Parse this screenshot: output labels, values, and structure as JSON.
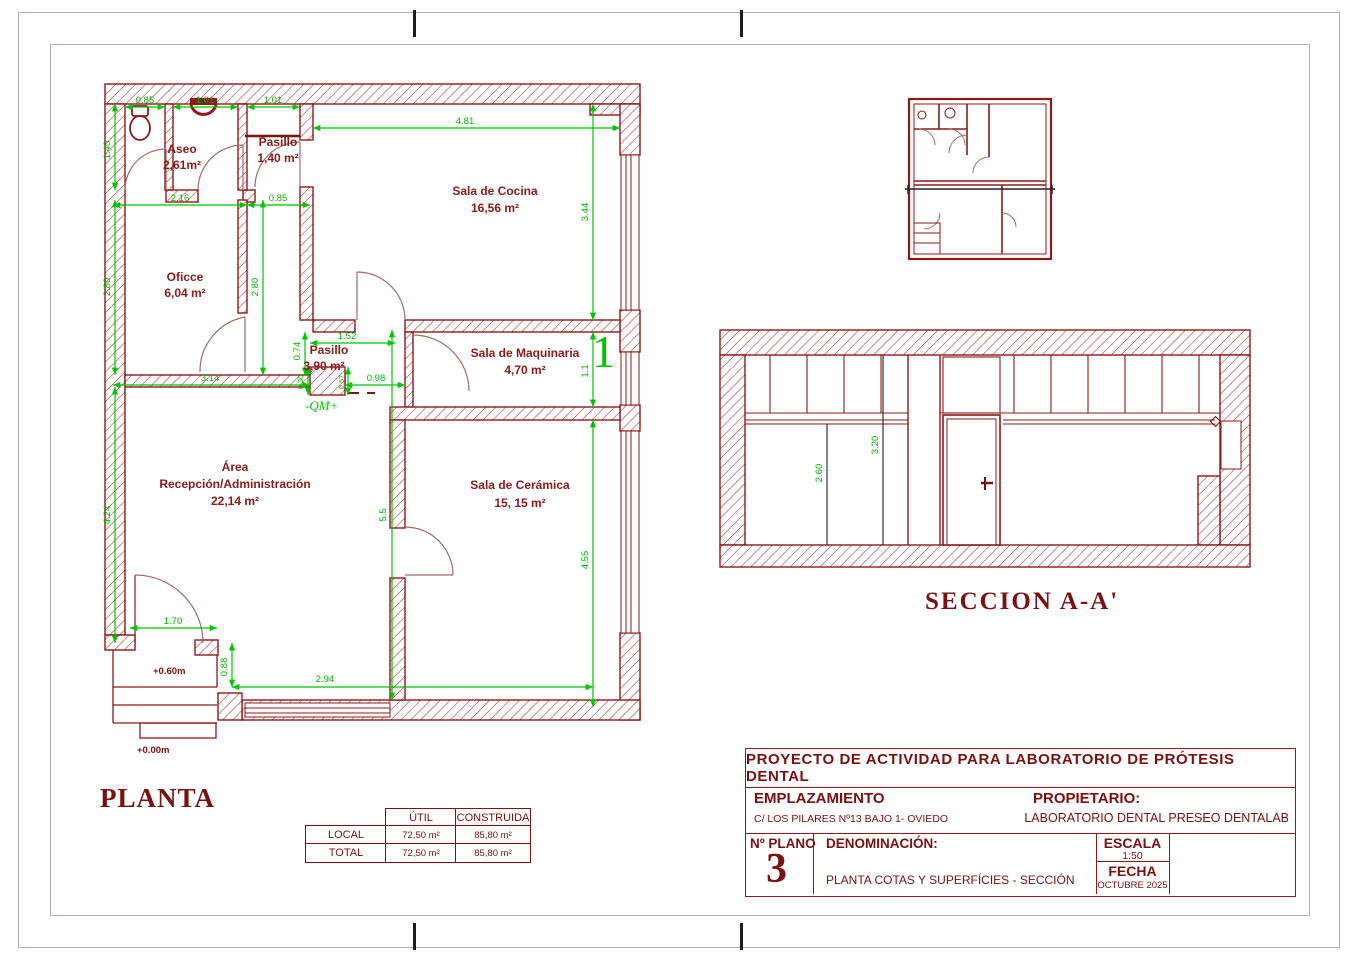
{
  "sheet": {
    "planta_label": "PLANTA",
    "seccion_label": "SECCION A-A'"
  },
  "plan": {
    "rooms": {
      "aseo": {
        "name": "Aseo",
        "area": "2,61m²"
      },
      "pasillo_top": {
        "name": "Pasillo",
        "area": "1,40 m²"
      },
      "oficce": {
        "name": "Oficce",
        "area": "6,04 m²"
      },
      "cocina": {
        "name": "Sala de Cocina",
        "area": "16,56 m²"
      },
      "pasillo_mid": {
        "name": "Pasillo",
        "area": "3,90 m²"
      },
      "maquinaria": {
        "name": "Sala de Maquinaria",
        "area": "4,70 m²"
      },
      "recepcion": {
        "line1": "Área",
        "line2": "Recepción/Administración",
        "area": "22,14 m²"
      },
      "ceramica": {
        "name": "Sala de Cerámica",
        "area": "15, 15 m²"
      }
    },
    "dims": {
      "aseo_w": "0.85",
      "sink_w": "1.01",
      "pasillo_w": "1.01",
      "cocina_w": "4.81",
      "aseo_total_w": "2.16",
      "pasillo_mid_w": "0.85",
      "aseo_h": "1.40",
      "oficce_h": "2.80",
      "oficce_h_inner": "2.80",
      "recepcion_h": "4.24",
      "cocina_h": "3.44",
      "maquinaria_h": "1.1",
      "ceramica_h": "4.55",
      "recepcion_inner_h": "5.5",
      "pasillo_len": "1.52",
      "pasillo_h": "0.74",
      "recepcion_w": "3.14",
      "col_w": "0.30",
      "col_d": "0.57",
      "door_w": "0.98",
      "entrance_w": "1.70",
      "entrance_d": "0.88",
      "bottom_w": "2.94"
    },
    "levels": {
      "porch": "+0.60m",
      "street": "+0.00m"
    },
    "section_marker": "1",
    "qm_note": "-QM+"
  },
  "section": {
    "dims": {
      "ceiling_height": "2.60",
      "slab_height": "3.20"
    }
  },
  "surface_table": {
    "col_util": "ÚTIL",
    "col_construida": "CONSTRUIDA",
    "rows": [
      {
        "label": "LOCAL",
        "util": "72,50 m²",
        "construida": "85,80 m²"
      },
      {
        "label": "TOTAL",
        "util": "72,50 m²",
        "construida": "85,80 m²"
      }
    ]
  },
  "title_block": {
    "project": "PROYECTO DE ACTIVIDAD PARA LABORATORIO DE PRÓTESIS DENTAL",
    "emplazamiento_label": "EMPLAZAMIENTO",
    "emplazamiento": "C/ LOS PILARES Nº13 BAJO 1- OVIEDO",
    "propietario_label": "PROPIETARIO:",
    "propietario": "LABORATORIO DENTAL PRESEO DENTALAB",
    "num_plano_label": "Nº PLANO",
    "num_plano": "3",
    "denominacion_label": "DENOMINACIÓN:",
    "denominacion": "PLANTA COTAS Y SUPERFÍCIES - SECCIÓN",
    "escala_label": "ESCALA",
    "escala": "1:50",
    "fecha_label": "FECHA",
    "fecha": "OCTUBRE 2025"
  },
  "colors": {
    "wall": "#8b1a1a",
    "dim_green": "#00c400",
    "title_red": "#7a1010"
  }
}
